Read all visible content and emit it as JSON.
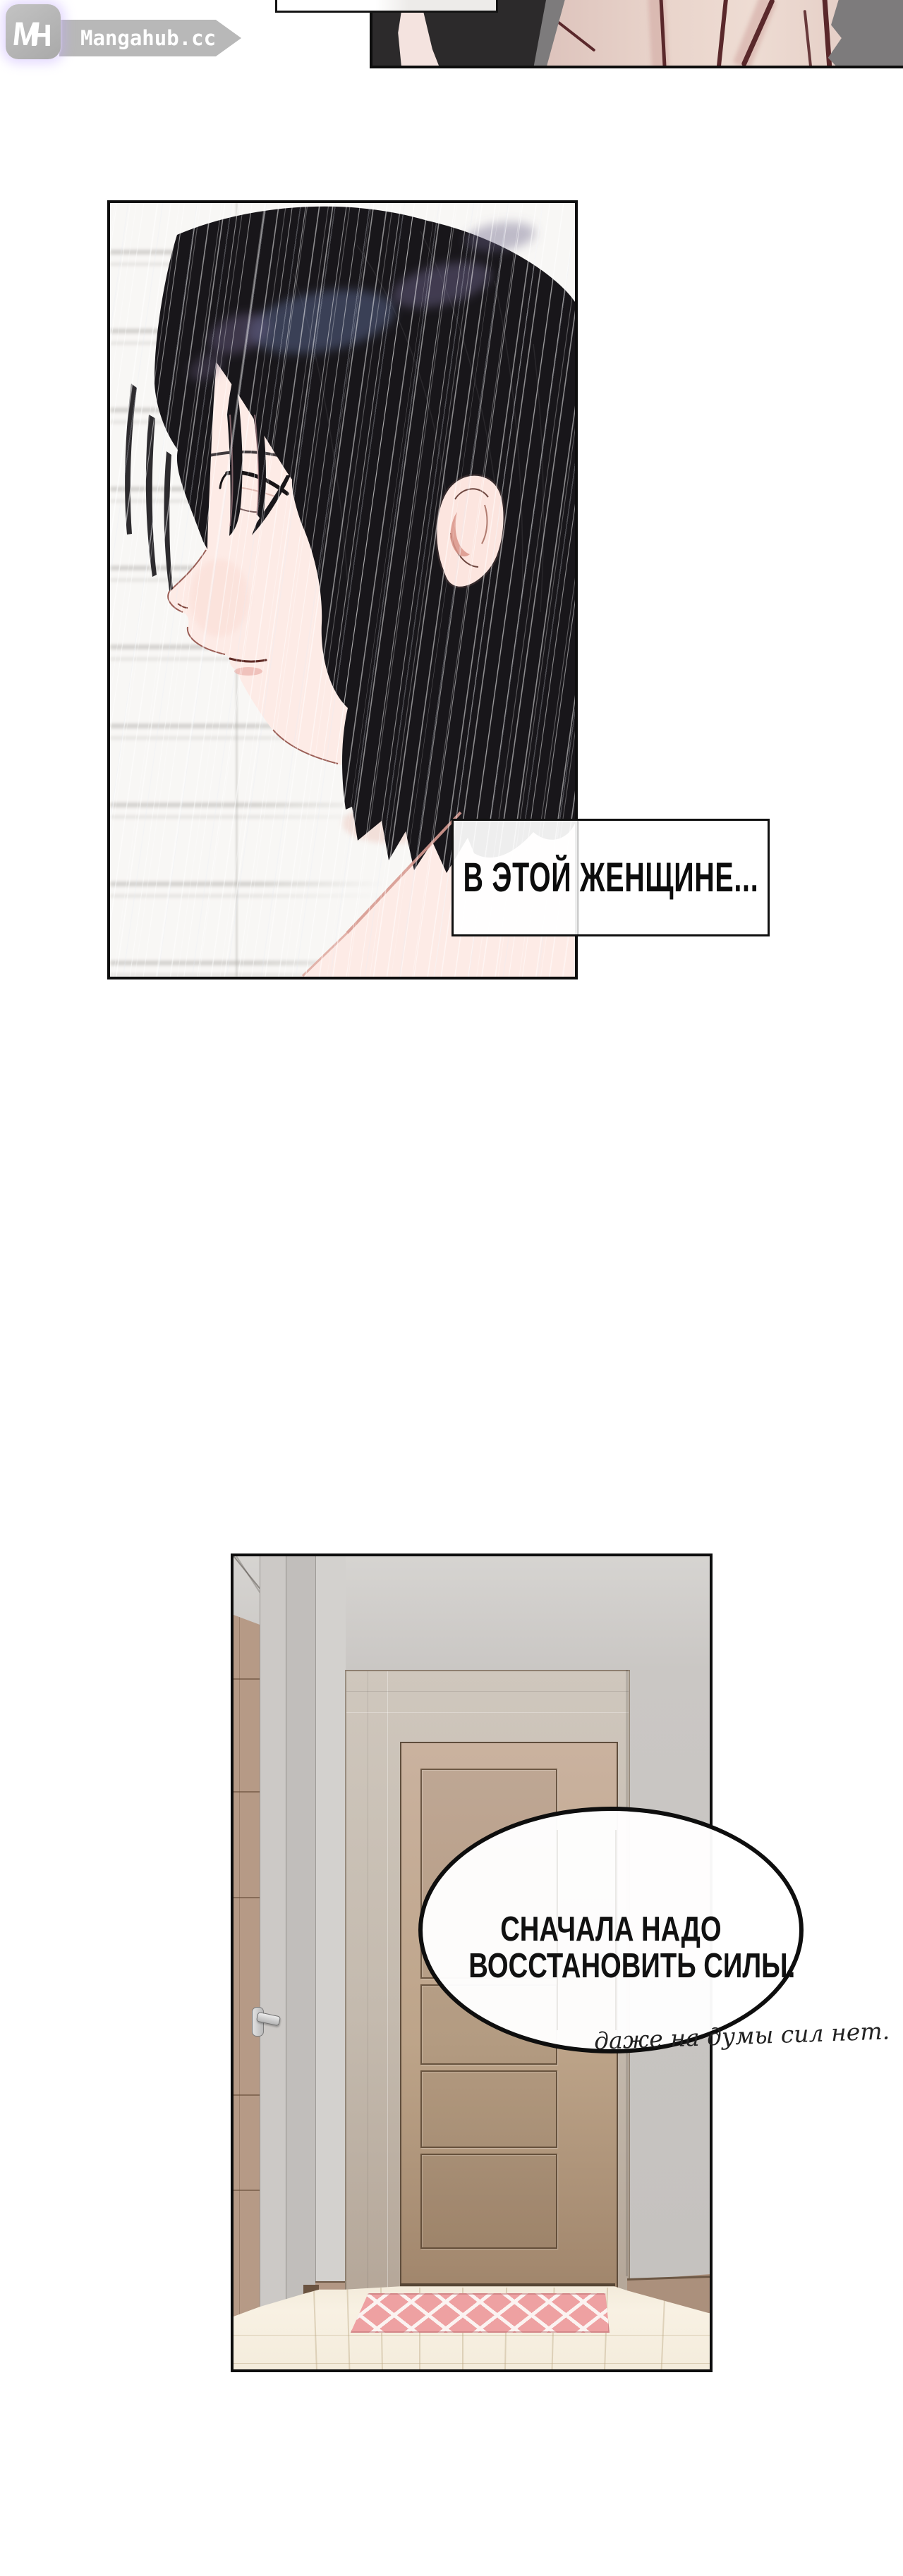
{
  "watermark": {
    "monogram_m": "M",
    "monogram_h": "H",
    "site_name": "Mangahub.cc"
  },
  "portrait_panel": {
    "caption": "В ЭТОЙ ЖЕНЩИНЕ..."
  },
  "hallway_panel": {
    "bubble_line1": "СНАЧАЛА НАДО",
    "bubble_line2": "ВОССТАНОВИТЬ СИЛЫ.",
    "handwritten_note": "даже на думы сил нет."
  },
  "colors": {
    "page_background": "#ffffff",
    "panel_border": "#0d0d0d",
    "watermark_gray": "#b8b8b8",
    "watermark_glow_pink": "#ff96af",
    "watermark_glow_violet": "#c3aaff",
    "hair_black": "#18161a",
    "hair_glint_blue": "#566086",
    "hair_glint_violet": "#6a5f85",
    "skin_face": "#fdebe6",
    "skin_closeup": "#e9d4cb",
    "crease_maroon": "#5a282b",
    "background_gray_panel": "#7d7b7c",
    "wall_gray": "#c9c6c3",
    "door_tan": "#bda489",
    "rug_pink": "#eea1a2",
    "floor_cream": "#f6efe1"
  }
}
